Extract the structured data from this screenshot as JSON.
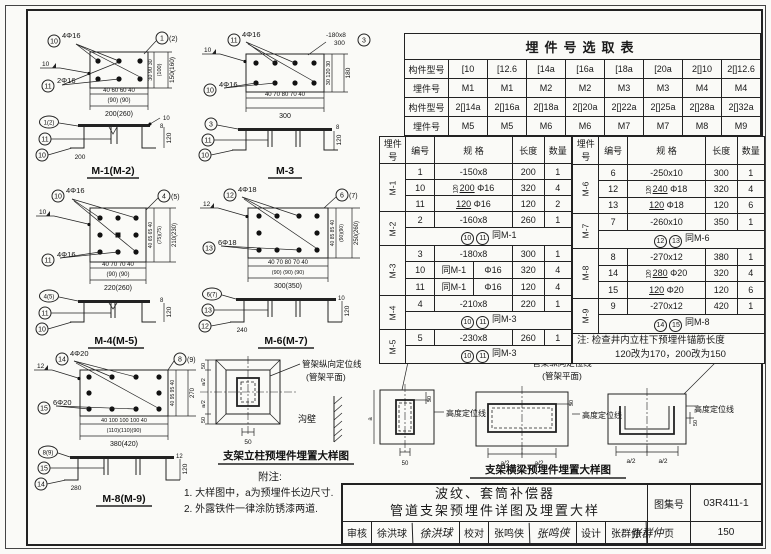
{
  "page": {
    "catalog_label": "图集号",
    "catalog_no": "03R411-1",
    "page_label": "页",
    "page_no": "150"
  },
  "title_block": {
    "title_line1": "波纹、套筒补偿器",
    "title_line2": "管道支架预埋件详图及埋置大样",
    "review_label": "审核",
    "review_name": "徐洪球",
    "review_sig": "徐洪球",
    "check_label": "校对",
    "check_name": "张鸣侠",
    "check_sig": "张鸣侠",
    "design_label": "设计",
    "design_name": "张群仲",
    "design_sig": "张群仲"
  },
  "selection_table": {
    "title": "埋件号选取表",
    "row_labels": [
      "构件型号",
      "埋件号",
      "构件型号",
      "埋件号"
    ],
    "rows": [
      [
        "[10",
        "[12.6",
        "[14a",
        "[16a",
        "[18a",
        "[20a",
        "2[]10",
        "2[]12.6"
      ],
      [
        "M1",
        "M1",
        "M2",
        "M2",
        "M3",
        "M3",
        "M4",
        "M4"
      ],
      [
        "2[]14a",
        "2[]16a",
        "2[]18a",
        "2[]20a",
        "2[]22a",
        "2[]25a",
        "2[]28a",
        "2[]32a"
      ],
      [
        "M5",
        "M5",
        "M6",
        "M6",
        "M7",
        "M7",
        "M8",
        "M9"
      ]
    ]
  },
  "parts_table": {
    "headers": [
      "埋件号",
      "编号",
      "规  格",
      "长度",
      "数量"
    ],
    "left": [
      {
        "name": "M-1",
        "rows": [
          {
            "no": "1",
            "plate": "-150x8",
            "len": "200",
            "qty": "1"
          },
          {
            "no": "10",
            "v": "120",
            "h": "200",
            "dia": "Φ16",
            "len": "320",
            "qty": "4"
          },
          {
            "no": "11",
            "h": "120",
            "dia": "Φ16",
            "len": "120",
            "qty": "2"
          }
        ]
      },
      {
        "name": "M-2",
        "rows": [
          {
            "no": "2",
            "plate": "-160x8",
            "len": "260",
            "qty": "1"
          }
        ],
        "same_a": "10",
        "same_b": "11",
        "same": "同M-1"
      },
      {
        "name": "M-3",
        "rows": [
          {
            "no": "3",
            "plate": "-180x8",
            "len": "300",
            "qty": "1"
          },
          {
            "no": "10",
            "ref": "同M-1",
            "dia": "Φ16",
            "len": "320",
            "qty": "4"
          },
          {
            "no": "11",
            "ref": "同M-1",
            "dia": "Φ16",
            "len": "120",
            "qty": "4"
          }
        ]
      },
      {
        "name": "M-4",
        "rows": [
          {
            "no": "4",
            "plate": "-210x8",
            "len": "220",
            "qty": "1"
          }
        ],
        "same_a": "10",
        "same_b": "11",
        "same": "同M-3"
      },
      {
        "name": "M-5",
        "rows": [
          {
            "no": "5",
            "plate": "-230x8",
            "len": "260",
            "qty": "1"
          }
        ],
        "same_a": "10",
        "same_b": "11",
        "same": "同M-3"
      }
    ],
    "right": [
      {
        "name": "M-6",
        "rows": [
          {
            "no": "6",
            "plate": "-250x10",
            "len": "300",
            "qty": "1"
          },
          {
            "no": "12",
            "v": "120",
            "h": "240",
            "dia": "Φ18",
            "len": "320",
            "qty": "4"
          },
          {
            "no": "13",
            "h": "120",
            "dia": "Φ18",
            "len": "120",
            "qty": "6"
          }
        ]
      },
      {
        "name": "M-7",
        "rows": [
          {
            "no": "7",
            "plate": "-260x10",
            "len": "350",
            "qty": "1"
          }
        ],
        "same_a": "12",
        "same_b": "13",
        "same": "同M-6"
      },
      {
        "name": "M-8",
        "rows": [
          {
            "no": "8",
            "plate": "-270x12",
            "len": "380",
            "qty": "1"
          },
          {
            "no": "14",
            "v": "120",
            "h": "280",
            "dia": "Φ20",
            "len": "320",
            "qty": "4"
          },
          {
            "no": "15",
            "h": "120",
            "dia": "Φ20",
            "len": "120",
            "qty": "6"
          }
        ]
      },
      {
        "name": "M-9",
        "rows": [
          {
            "no": "9",
            "plate": "-270x12",
            "len": "420",
            "qty": "1"
          }
        ],
        "same_a": "14",
        "same_b": "15",
        "same": "同M-8"
      }
    ],
    "note1": "注: 检查井内立柱下预埋件锚筋长度",
    "note2": "120改为170，200改为150"
  },
  "diagrams": {
    "m1": {
      "title": "M-1(M-2)",
      "bar_top_id": "10",
      "bar_top": "4Φ16",
      "bar_mid_id": "11",
      "bar_mid": "2Φ16",
      "weld": "10",
      "plate_id": "1",
      "plate_id_alt": "(2)",
      "sec_id": "1(2)",
      "sec_hook": "200",
      "sec_depth": "120",
      "sec_thick": "8",
      "dim_b1": "40 60      60 40",
      "dim_b2": "(90)      (90)",
      "dim_b3": "200(260)",
      "dim_r1": "30  90  30",
      "dim_r2": "(100)",
      "dim_r3": "150(160)"
    },
    "m3": {
      "title": "M-3",
      "bar_top_id": "11",
      "bar_top": "4Φ16",
      "bar_bot_id": "10",
      "bar_bot": "4Φ16",
      "weld": "10",
      "spec": "-180x8",
      "spec_len": "300",
      "plate_id": "3",
      "sec_id": "3",
      "sec_depth": "120",
      "sec_thick": "8",
      "dim_b1": "40  70   80   70  40",
      "dim_b3": "300",
      "dim_r1": "30  120  30",
      "dim_r3": "180"
    },
    "m4": {
      "title": "M-4(M-5)",
      "bar_top_id": "10",
      "bar_top": "4Φ16",
      "bar_bot_id": "11",
      "bar_bot": "4Φ16",
      "weld": "10",
      "plate_id": "4",
      "plate_id_alt": "(5)",
      "sec_id": "4(5)",
      "sec_depth": "120",
      "sec_thick": "8",
      "dim_b1": "40 70     70 40",
      "dim_b2": "(90)    (90)",
      "dim_b3": "220(260)",
      "dim_r1": "40 65 65 40",
      "dim_r2": "(75)(75)",
      "dim_r3": "210(230)"
    },
    "m6": {
      "title": "M-6(M-7)",
      "bar_top_id": "12",
      "bar_top": "4Φ18",
      "bar_bot_id": "13",
      "bar_bot": "6Φ18",
      "weld": "12",
      "plate_id": "6",
      "plate_id_alt": "(7)",
      "sec_id": "6(7)",
      "sec_hook": "240",
      "sec_depth": "120",
      "sec_thick": "10",
      "dim_b1": "40 70  80  70 40",
      "dim_b2": "(90) (90) (90)",
      "dim_b3": "300(350)",
      "dim_r1": "40 85 85 40",
      "dim_r2": "(90)(90)",
      "dim_r3": "250(260)"
    },
    "m8": {
      "title": "M-8(M-9)",
      "bar_top_id": "14",
      "bar_top": "4Φ20",
      "bar_bot_id": "15",
      "bar_bot": "6Φ20",
      "weld": "12",
      "plate_id": "8",
      "plate_id_alt": "(9)",
      "sec_id": "8(9)",
      "sec_hook": "280",
      "sec_depth": "120",
      "sec_thick": "12",
      "dim_b1": "40 100 100 100 40",
      "dim_b2": "(110)(110)(90)",
      "dim_b3": "380(420)",
      "dim_r1": "40 95 95 40",
      "dim_r3": "270"
    }
  },
  "placement": {
    "column": {
      "title": "支架立柱预埋件埋置大样图",
      "axis_label": "管架纵向定位线",
      "axis_label2": "(管架平面)",
      "wall": "沟壁",
      "d50": "50",
      "da2": "a/2"
    },
    "beam": {
      "title": "支架横梁预埋件埋置大样图",
      "axis_label": "管架纵向定位线",
      "axis_label2": "(管架平面)",
      "height_label": "高度定位线",
      "d50": "50",
      "da2": "a/2",
      "da": "a"
    }
  },
  "notes": {
    "title": "附注:",
    "item1": "1. 大样图中，a为预埋件长边尺寸.",
    "item2": "2. 外露铁件一律涂防锈漆两道."
  }
}
